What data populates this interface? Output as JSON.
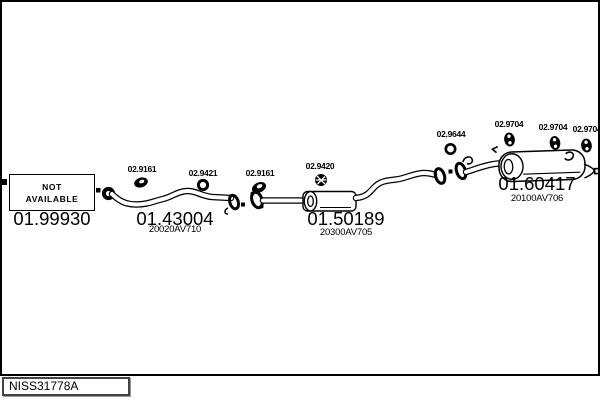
{
  "page": {
    "background": "#ffffff",
    "line_color": "#000000"
  },
  "plate": {
    "code": "NISS31778A"
  },
  "not_available": {
    "line1": "NOT",
    "line2": "AVAILABLE"
  },
  "parts": {
    "flex_connector": {
      "number": "01.99930"
    },
    "front_pipe": {
      "number": "01.43004",
      "oem_ref": "20020AV710"
    },
    "centre_silencer": {
      "number": "01.50189",
      "oem_ref": "20300AV705"
    },
    "rear_silencer": {
      "number": "01.60417",
      "oem_ref": "20100AV706"
    }
  },
  "fittings": {
    "gasket_front": {
      "number": "02.9161"
    },
    "ring_front": {
      "number": "02.9421"
    },
    "gasket_centre": {
      "number": "02.9161"
    },
    "seal_centre": {
      "number": "02.9420"
    },
    "ring_rear": {
      "number": "02.9644"
    },
    "hanger_1": {
      "number": "02.9704"
    },
    "hanger_2": {
      "number": "02.9704"
    },
    "hanger_3": {
      "number": "02.9704"
    }
  }
}
